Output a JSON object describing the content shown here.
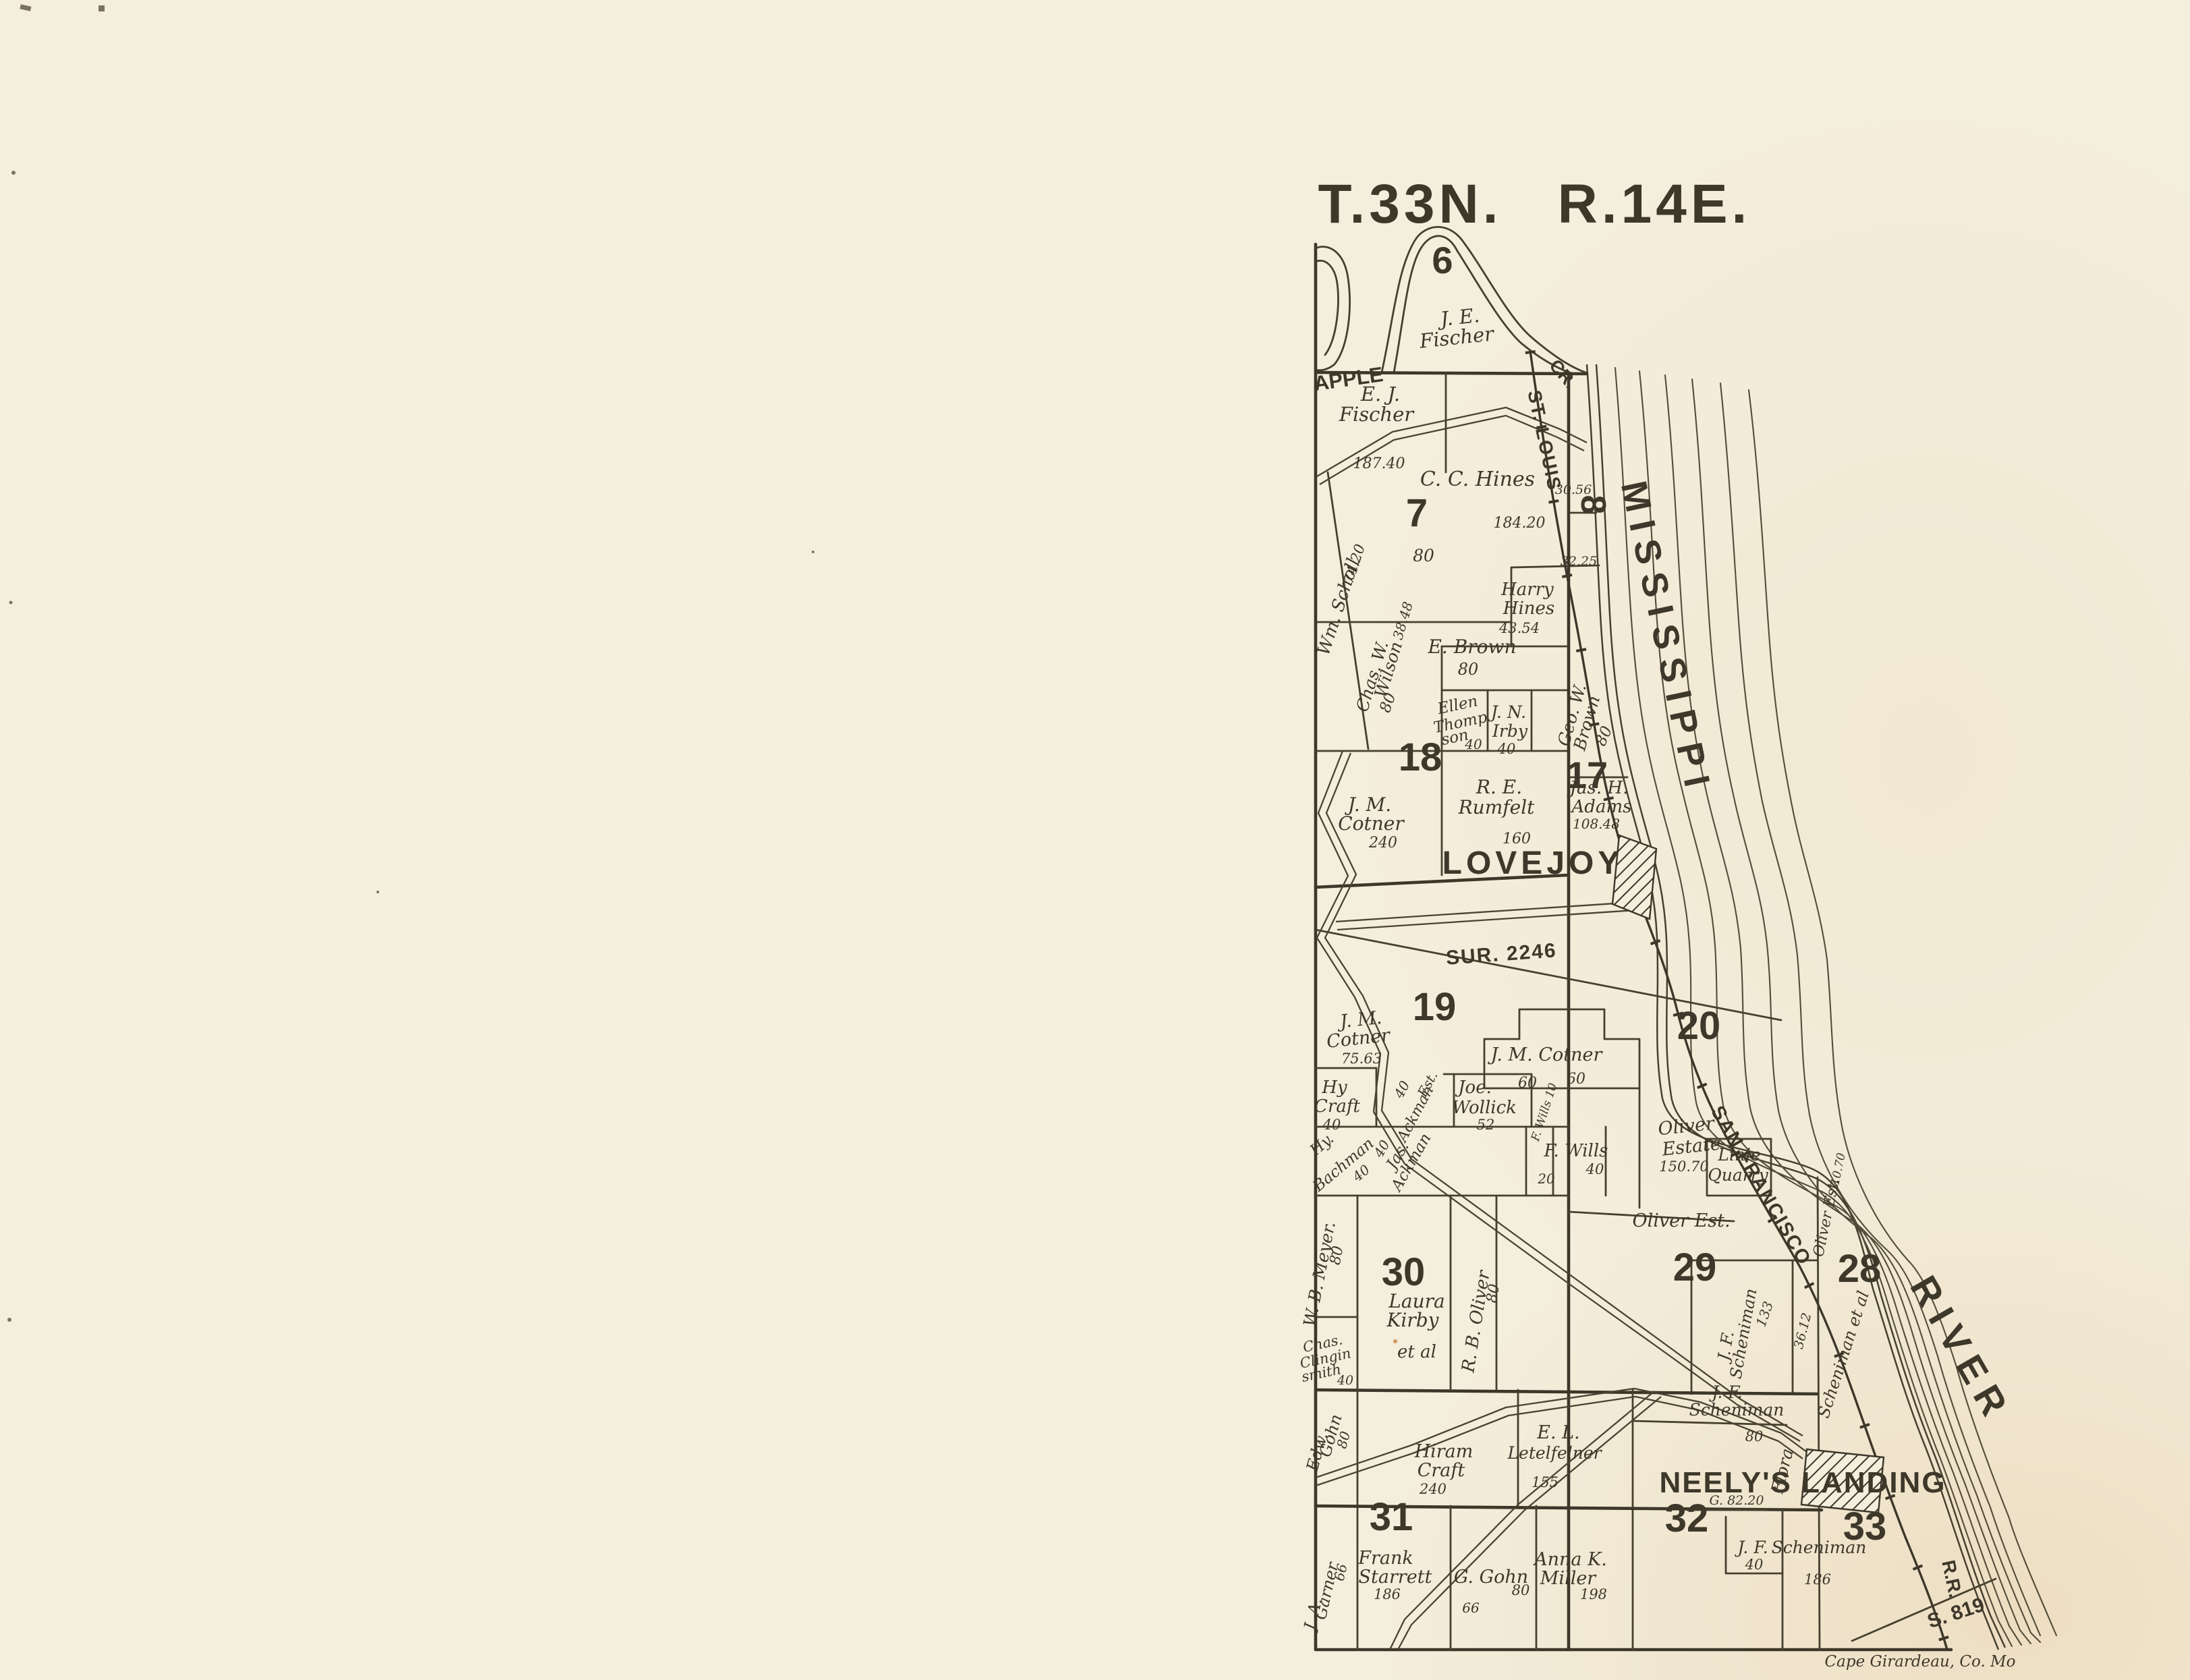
{
  "colors": {
    "paper": "#f4eedd",
    "paper_warm": "#eadfc2",
    "ink": "#3e382b"
  },
  "header": {
    "township": "T.33N.",
    "range": "R.14E."
  },
  "sections": {
    "s6": "6",
    "s7": "7",
    "s8": "8",
    "s17": "17",
    "s18": "18",
    "s19": "19",
    "s20": "20",
    "s28": "28",
    "s29": "29",
    "s30": "30",
    "s31": "31",
    "s32": "32",
    "s33": "33"
  },
  "towns": {
    "lovejoy": "LOVEJOY",
    "neelys_landing": "NEELY'S LANDING"
  },
  "water": {
    "mississippi": "MISSISSIPPI",
    "river": "RIVER",
    "apple_creek": "APPLE",
    "apple_creek_cr": "CR."
  },
  "railroad": {
    "st_louis": "ST. LOUIS",
    "san_francisco": "SAN FRANCISCO",
    "rr": "R.R.",
    "s819": "S. 819",
    "flora": "Flora"
  },
  "survey": {
    "sur2246": "SUR. 2246"
  },
  "credit": {
    "text": "Cape Girardeau, Co. Mo"
  },
  "labels": {
    "je1": "J. E.",
    "je2": "Fischer",
    "ej1": "E. J.",
    "ej2": "Fischer",
    "v18740": "187.40",
    "cc_hines": "C. C. Hines",
    "v3056": "30.56",
    "v18420": "184.20",
    "v3225": "32.25",
    "v80_hines": "80",
    "wm_scholl": "Wm. Scholl",
    "v7420": "74.20",
    "harry1": "Harry",
    "harry2": "Hines",
    "v4354": "43.54",
    "wilson1": "Chas. W.",
    "wilson2": "Wilson",
    "v3848": "38.48",
    "v80_wilson": "80",
    "e_brown": "E. Brown",
    "v80_brown": "80",
    "ellen1": "Ellen",
    "ellen2": "Thomp",
    "ellen3": "son",
    "v40_ellen": "40",
    "irby1": "J. N.",
    "irby2": "Irby",
    "v40_irby": "40",
    "geo1": "Geo. W.",
    "geo2": "Brown",
    "v80_geo": "80",
    "cot18a": "J. M.",
    "cot18b": "Cotner",
    "v240": "240",
    "rum1": "R. E.",
    "rum2": "Rumfelt",
    "v160": "160",
    "adams1": "Jas. H.",
    "adams2": "Adams",
    "v10848": "108.48",
    "cot19a": "J. M.",
    "cot19b": "Cotner",
    "v7563": "75.63",
    "cotner20": "J. M. Cotner",
    "v60a": "60",
    "v60b": "60",
    "oliv20a": "Oliver",
    "oliv20b": "Estate",
    "v15070": "150.70",
    "craft1": "Hy",
    "craft2": "Craft",
    "v40_craft": "40",
    "ackest1": "Ackman",
    "ackest2": "Est.",
    "v40_ackest": "40",
    "woll1": "Joe.",
    "woll2": "Wollick",
    "v52": "52",
    "wills_strip": "F. Wills 10",
    "wills1": "F. Wills",
    "v40_wills": "40",
    "v20_wills": "20",
    "bach1": "Hy.",
    "bach2": "Bachman",
    "v40_bach": "40",
    "jas1": "Jas.",
    "jas2": "Ackman",
    "v40_jas": "40",
    "oliver29": "Oliver Est.",
    "linie1": "Linie",
    "linie2": "Quarry",
    "oliver_strip": "Oliver Est.",
    "v1070": "10.70",
    "meyer": "W. B. Meyer.",
    "v80_meyer": "80",
    "kirby1": "Laura",
    "kirby2": "Kirby",
    "kirby3": "et al",
    "rb_oliver": "R. B. Oliver",
    "v80_rb": "80",
    "sch29a": "J. F.",
    "sch29b": "Scheniman",
    "v133": "133",
    "v3612": "36.12",
    "sch_etal": "Scheniman et al",
    "cling1": "Chas.",
    "cling2": "Clingin",
    "cling3": "smith",
    "v40_cling": "40",
    "edw1": "Edw.",
    "edw2": "Gohn",
    "v80_edw": "80",
    "sch32a": "J. F.",
    "sch32b": "Scheniman",
    "v80_sch32": "80",
    "hiram1": "Hiram",
    "hiram2": "Craft",
    "v240_hiram": "240",
    "letel1": "E. L.",
    "letel2": "Letelfelner",
    "v155": "155",
    "g8220": "G. 82.20",
    "garner1": "J. A.",
    "garner2": "Garner",
    "v66_garner": "66",
    "star1": "Frank",
    "star2": "Starrett",
    "v186_star": "186",
    "g_gohn": "G. Gohn",
    "v80_ggohn": "80",
    "v66_ggohn": "66",
    "mill1": "Anna K.",
    "mill2": "Miller",
    "v198": "198",
    "sch33a": "J. F.",
    "sch33b": "Scheniman",
    "v40_sch33": "40",
    "v186_sch33": "186"
  }
}
